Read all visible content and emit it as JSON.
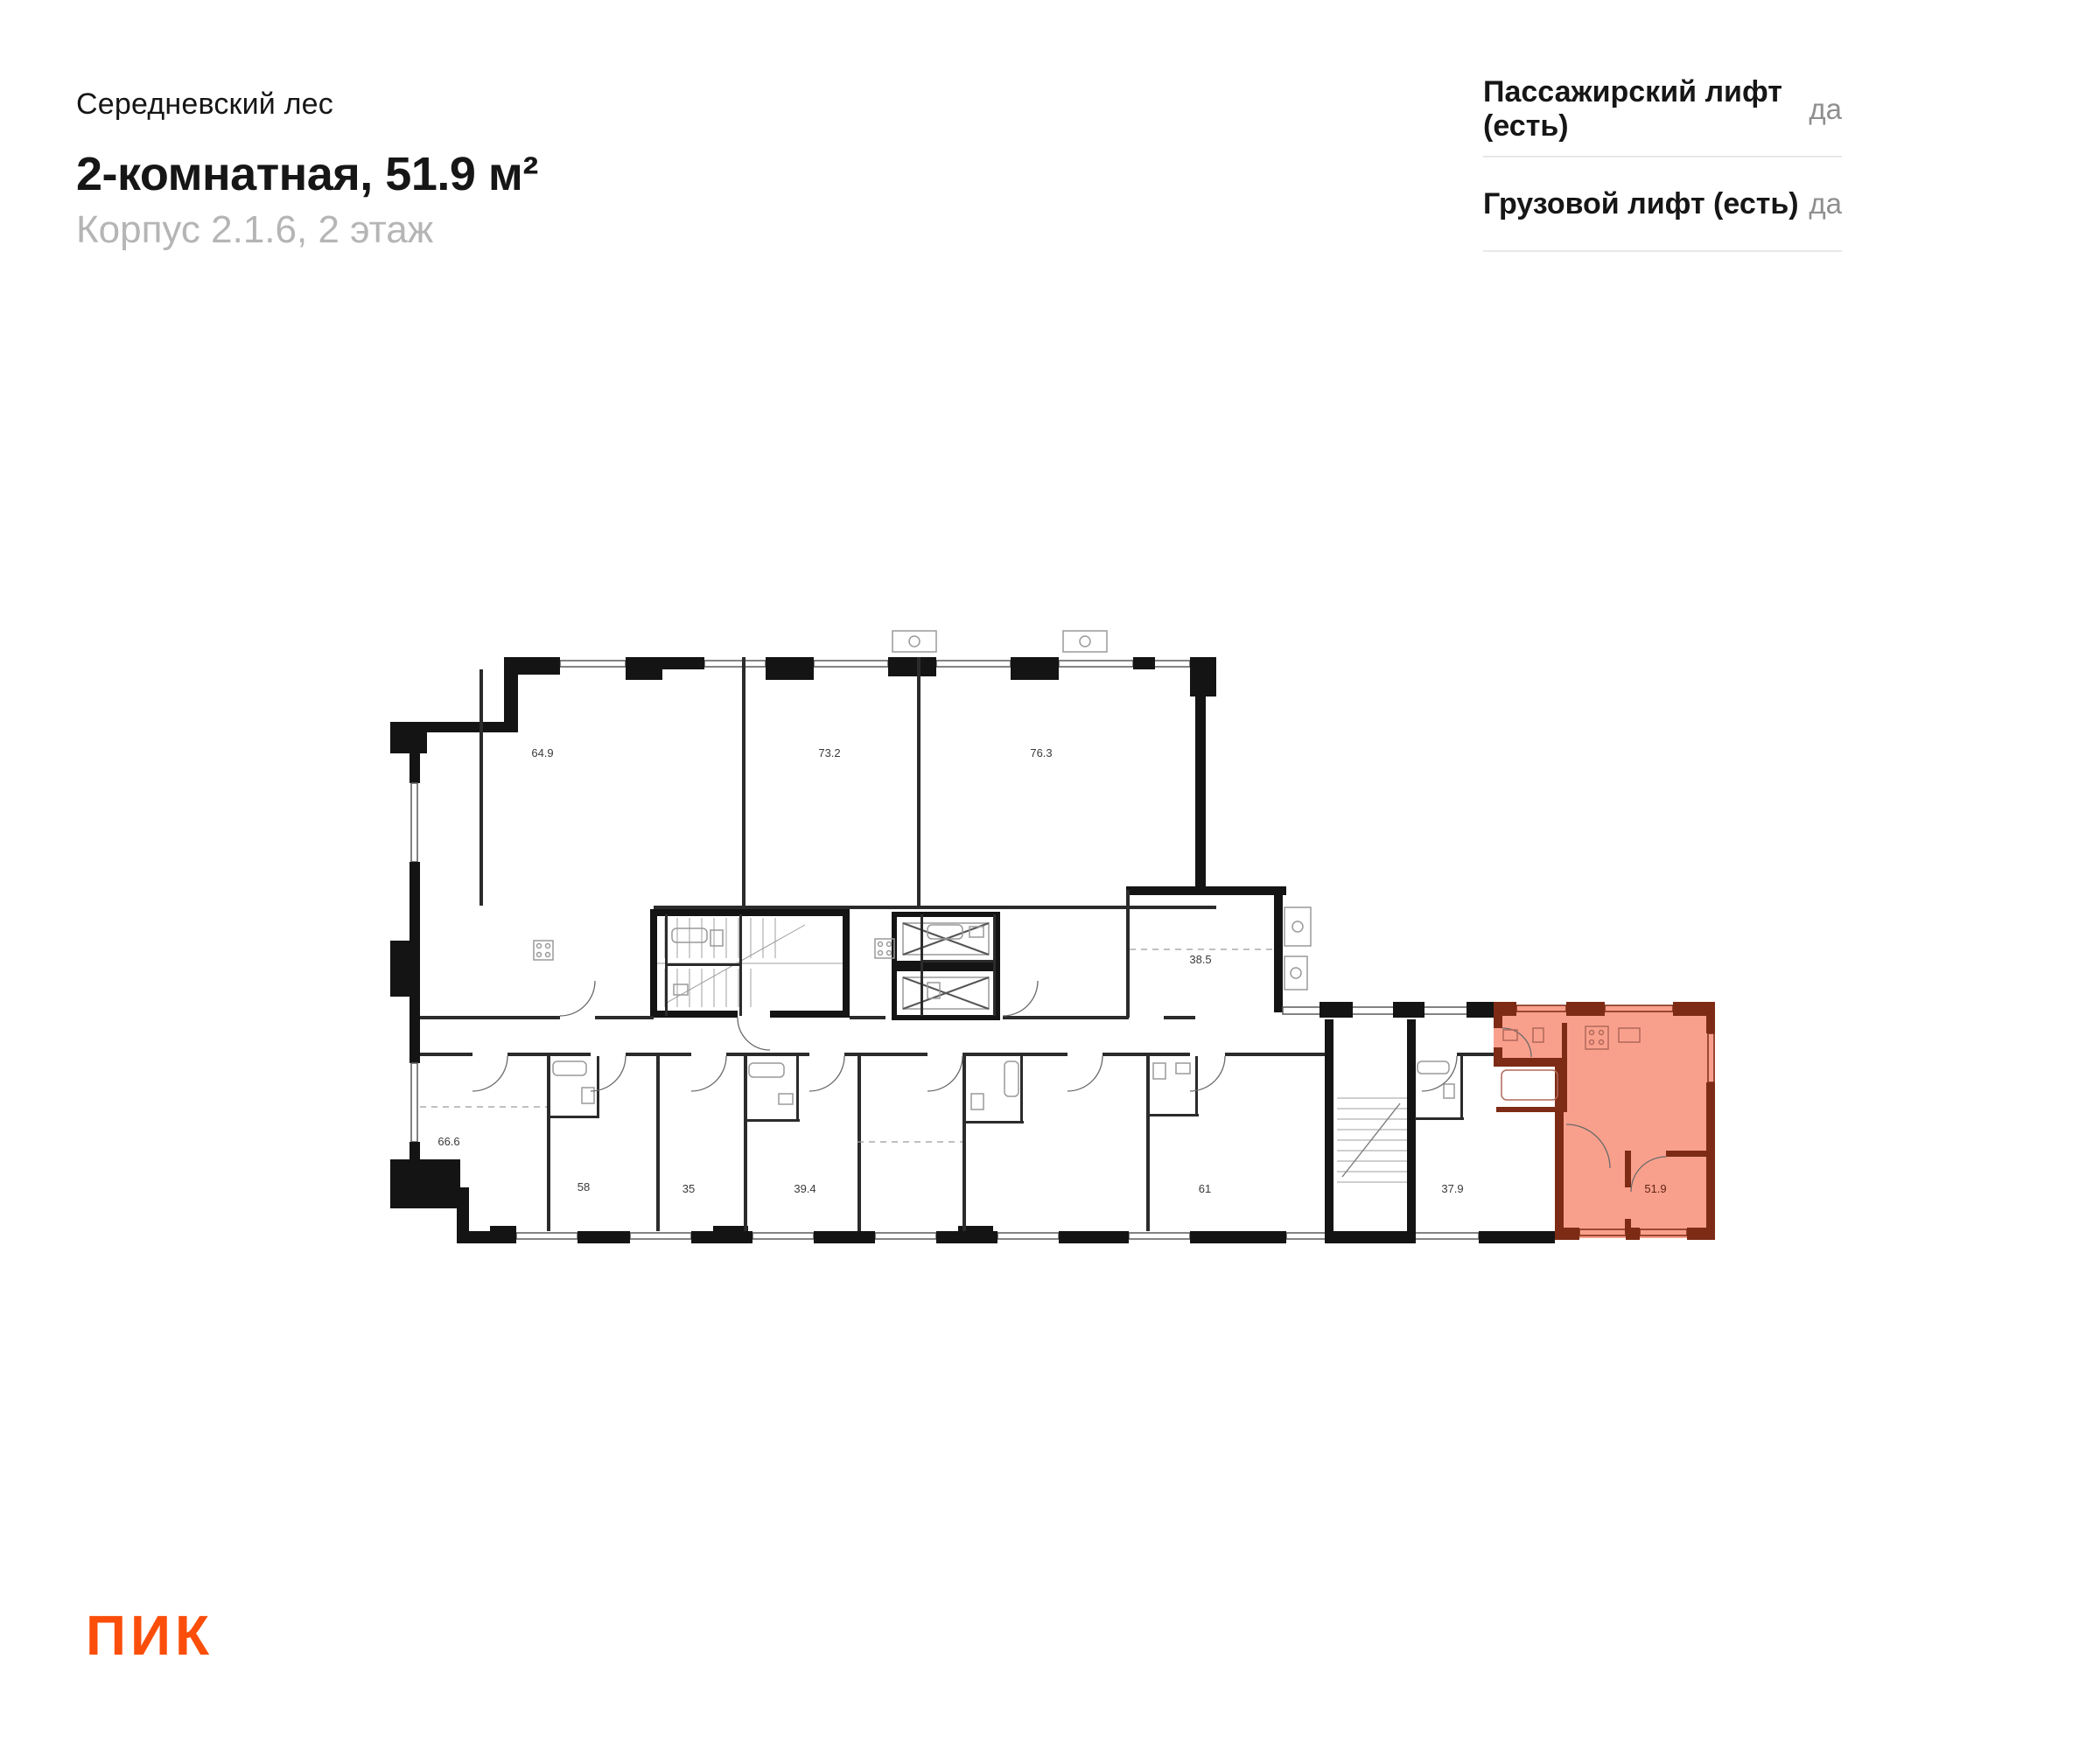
{
  "header": {
    "project": "Середневский лес",
    "title": "2-комнатная, 51.9 м²",
    "subtitle": "Корпус 2.1.6, 2 этаж"
  },
  "info": {
    "rows": [
      {
        "label": "Пассажирский лифт (есть)",
        "value": "да"
      },
      {
        "label": "Грузовой лифт (есть)",
        "value": "да"
      }
    ]
  },
  "plan": {
    "highlighted_unit": {
      "area": "51.9",
      "type": "2-комнатная"
    },
    "units": [
      {
        "area": "64.9"
      },
      {
        "area": "73.2"
      },
      {
        "area": "76.3"
      },
      {
        "area": "38.5"
      },
      {
        "area": "66.6"
      },
      {
        "area": "58"
      },
      {
        "area": "35"
      },
      {
        "area": "39.4"
      },
      {
        "area": "61"
      },
      {
        "area": "37.9"
      }
    ]
  },
  "logo": {
    "text": "ПИК"
  },
  "theme": {
    "accent": "#FB4E0A",
    "highlight-fill": "#F9A08D",
    "highlight-wall": "#7D2B15",
    "title-color": "#161616",
    "subtitle-color": "#B5B5B5",
    "value-color": "#8F8F8F",
    "divider": "#E8E8E8"
  }
}
